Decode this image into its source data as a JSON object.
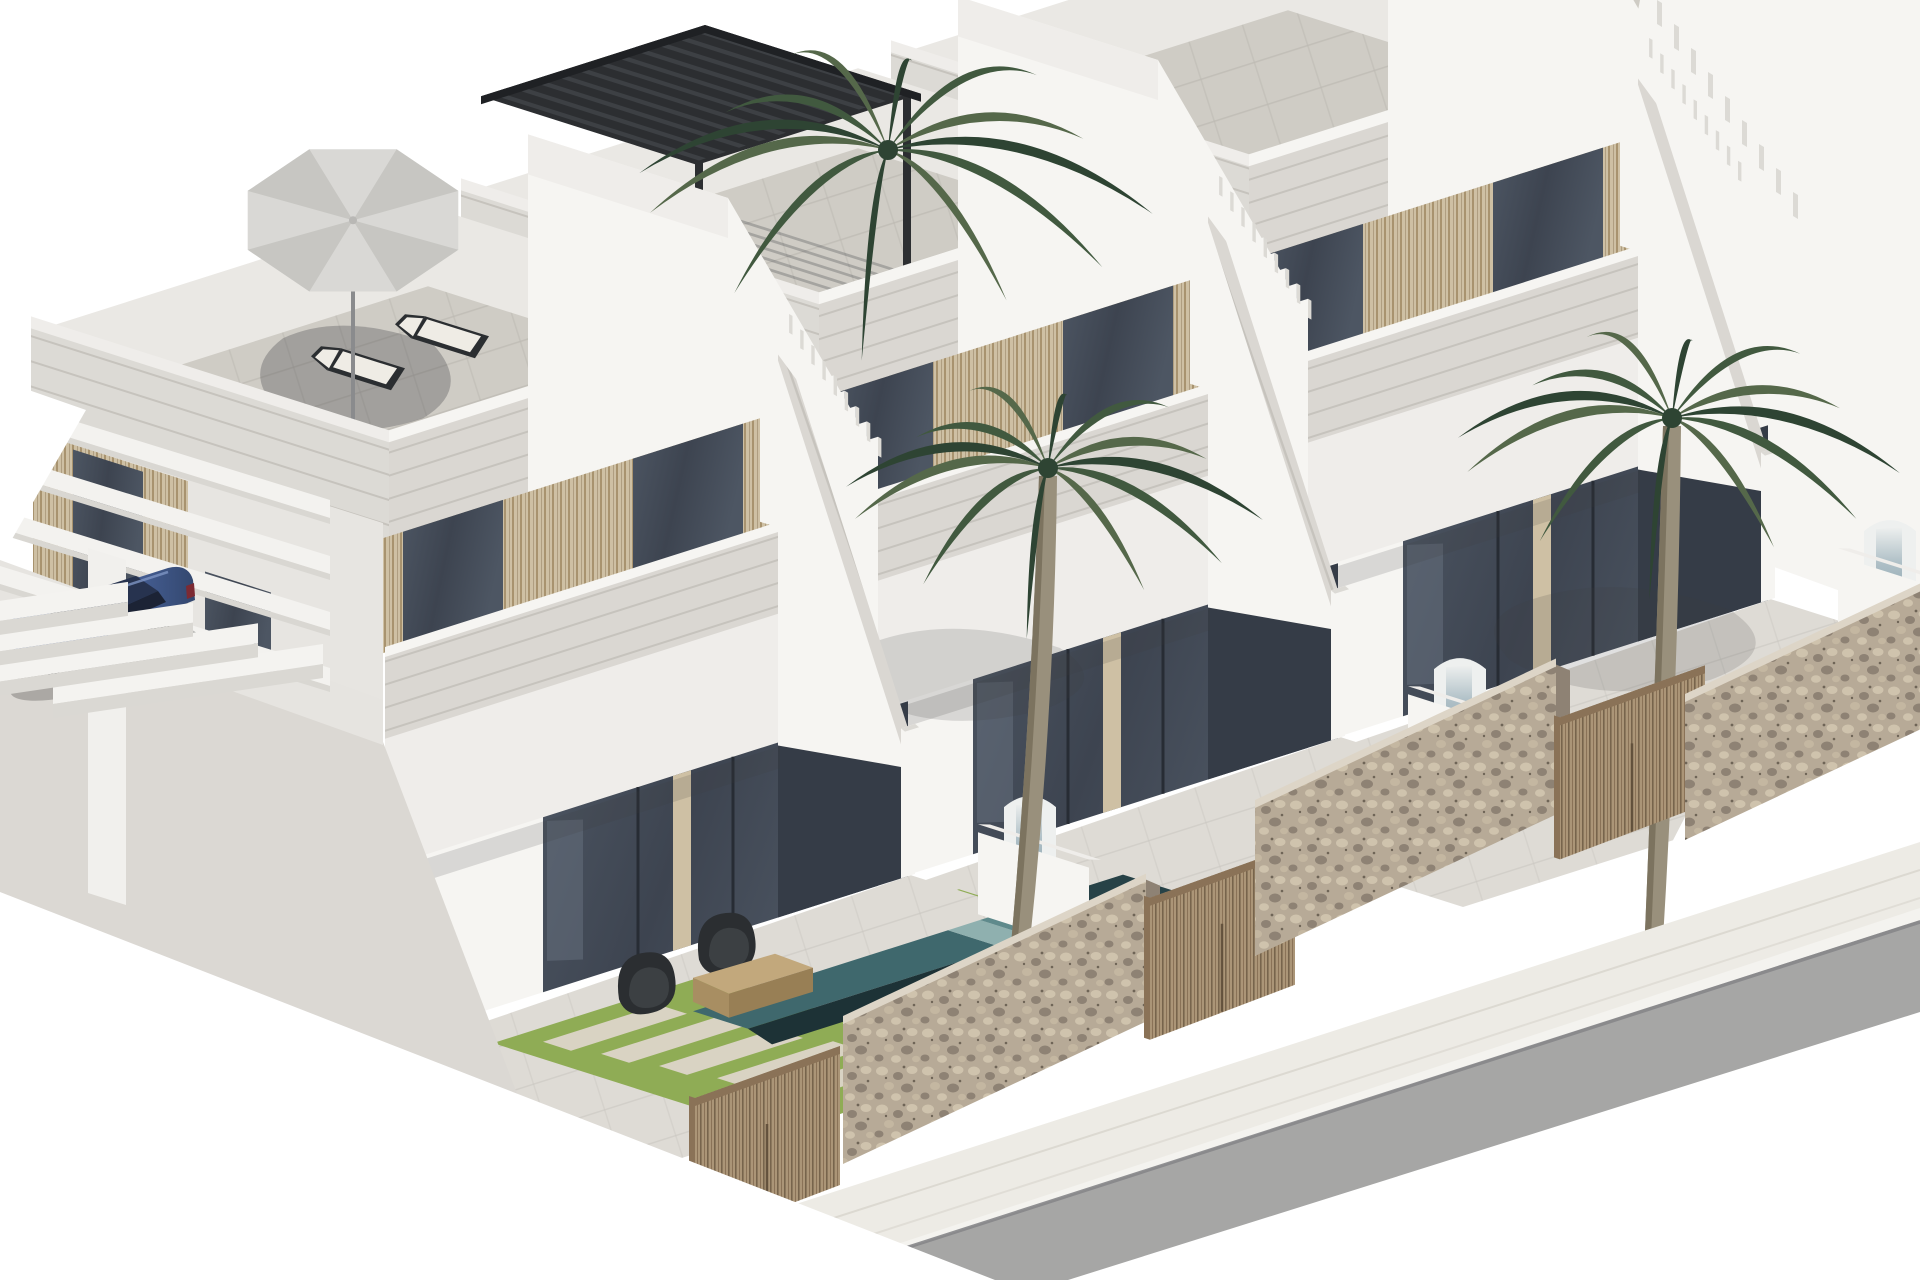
{
  "scene": {
    "title": "Architectural 3D render: row of modern white two-storey villas with roof terraces, private pools, palm trees, stone street walls and a parked blue car",
    "canvas": {
      "width": 1920,
      "height": 1280
    },
    "palette": {
      "sky": "#ffffff",
      "facade_bright": "#f6f5f2",
      "facade_light": "#efedea",
      "facade_side": "#e7e5e1",
      "facade_shade": "#dcdad5",
      "band_base": "#dad7d2",
      "band_line": "#c6c3bd",
      "roof_tile": "#cfccc5",
      "roof_line": "#bdbab3",
      "inner_parapet": "#eae8e4",
      "wood_light": "#cec0a4",
      "wood_dark": "#a8936f",
      "wood_line": "#8f7c5e",
      "glass_dark": "#3d4450",
      "glass_mid": "#4d5663",
      "glass_light": "#68727f",
      "porch_dark": "#353c47",
      "frame_dark": "#272c34",
      "terrace_tile": "#dedbd5",
      "terrace_line": "#c8c5be",
      "grass": "#8fac55",
      "grass_light": "#a3bc66",
      "paver": "#d9d3c3",
      "pool_deep": "#274247",
      "pool_mid": "#3f686d",
      "pool_step": "#8fb0af",
      "pool_step_dark": "#5f8a8c",
      "pool_coping": "#1d3236",
      "waterfall_white": "#eef0ef",
      "waterfall_blue": "#aebfc6",
      "stone_base": "#b7aa97",
      "stone_dark": "#8e8274",
      "stone_light": "#cfc3ad",
      "stone_cap": "#ddd5c7",
      "gate_wood": "#ab9577",
      "gate_wood_dark": "#8a7257",
      "gate_line": "#6f5c44",
      "sidewalk": "#edebe5",
      "sidewalk_line": "#d8d5cd",
      "curb": "#f4f3ef",
      "road": "#a6a6a5",
      "road_edge": "#87878a",
      "car_body": "#4d68a4",
      "car_body_light": "#6e87bc",
      "car_body_dark": "#33476e",
      "car_roof": "#27334f",
      "car_glass": "#1c2335",
      "car_wheel": "#17191d",
      "car_tail": "#7c2a33",
      "palm_dark": "#2e4433",
      "palm_mid": "#41593f",
      "palm_light": "#55684a",
      "palm_trunk": "#99907c",
      "palm_trunk_dark": "#7c735f",
      "umbrella": "#d9d8d5",
      "umbrella_dark": "#c7c6c2",
      "pergola": "#2c2e31",
      "furniture_dark": "#2b2e31",
      "furniture_wood": "#c2a87c",
      "cushion": "#efece5",
      "chair_white": "#e9e8e4",
      "table_dark": "#35281f",
      "shadow": "rgba(45,48,55,0.28)",
      "shadow_soft": "rgba(60,64,60,0.16)"
    },
    "objects": [
      "villa-1 with roof terrace, parasol, two sun loungers, balcony dining set, garden lounge chairs, coffee table, pool, carport pergola, garage",
      "villa-2 with black louvered roof pergola, pool, waterfall feature",
      "villa-3 with stair parapet and pool",
      "villa-4 partial roofs at top right",
      "three palm trees",
      "stone street walls",
      "wooden slat gates",
      "blue sedan car",
      "sidewalk and asphalt road"
    ],
    "villas": [
      {
        "id": "villa-1",
        "front_corner": [
          833,
          900
        ],
        "features": [
          "umbrella",
          "loungers",
          "balcony-furniture",
          "terrace-furniture",
          "carport",
          "garage",
          "big-grass",
          "pool"
        ]
      },
      {
        "id": "villa-2",
        "front_corner": [
          1263,
          762
        ],
        "features": [
          "pergola",
          "pool",
          "waterfall",
          "grass-strips"
        ]
      },
      {
        "id": "villa-3",
        "front_corner": [
          1693,
          624
        ],
        "features": [
          "pool",
          "waterfall",
          "grass-strips"
        ]
      }
    ],
    "palms": [
      {
        "id": "palm-back-left",
        "center": [
          888,
          150
        ],
        "size": 265,
        "trunk": false
      },
      {
        "id": "palm-center",
        "center": [
          1048,
          468
        ],
        "size": 215,
        "trunk": true,
        "trunk_base": [
          1008,
          1062
        ]
      },
      {
        "id": "palm-right",
        "center": [
          1672,
          418
        ],
        "size": 228,
        "trunk": true,
        "trunk_base": [
          1648,
          1048
        ]
      }
    ],
    "car": {
      "type": "blue sedan",
      "position": [
        100,
        620
      ]
    },
    "street": {
      "gates_x": [
        695,
        1150,
        1560
      ],
      "walls": [
        {
          "x0": 843,
          "y0": 1022,
          "x1": 1146,
          "h": 142
        },
        {
          "x0": 1255,
          "y0": 806,
          "x1": 1556,
          "h": 150
        },
        {
          "x0": 1685,
          "y0": 700,
          "x1": 1922,
          "h": 140
        }
      ],
      "sidewalk": [
        [
          560,
          1280
        ],
        [
          1920,
          842
        ],
        [
          1920,
          920
        ],
        [
          806,
          1280
        ]
      ],
      "road": [
        [
          806,
          1280
        ],
        [
          1920,
          920
        ],
        [
          1920,
          1012
        ],
        [
          1068,
          1280
        ]
      ]
    }
  }
}
